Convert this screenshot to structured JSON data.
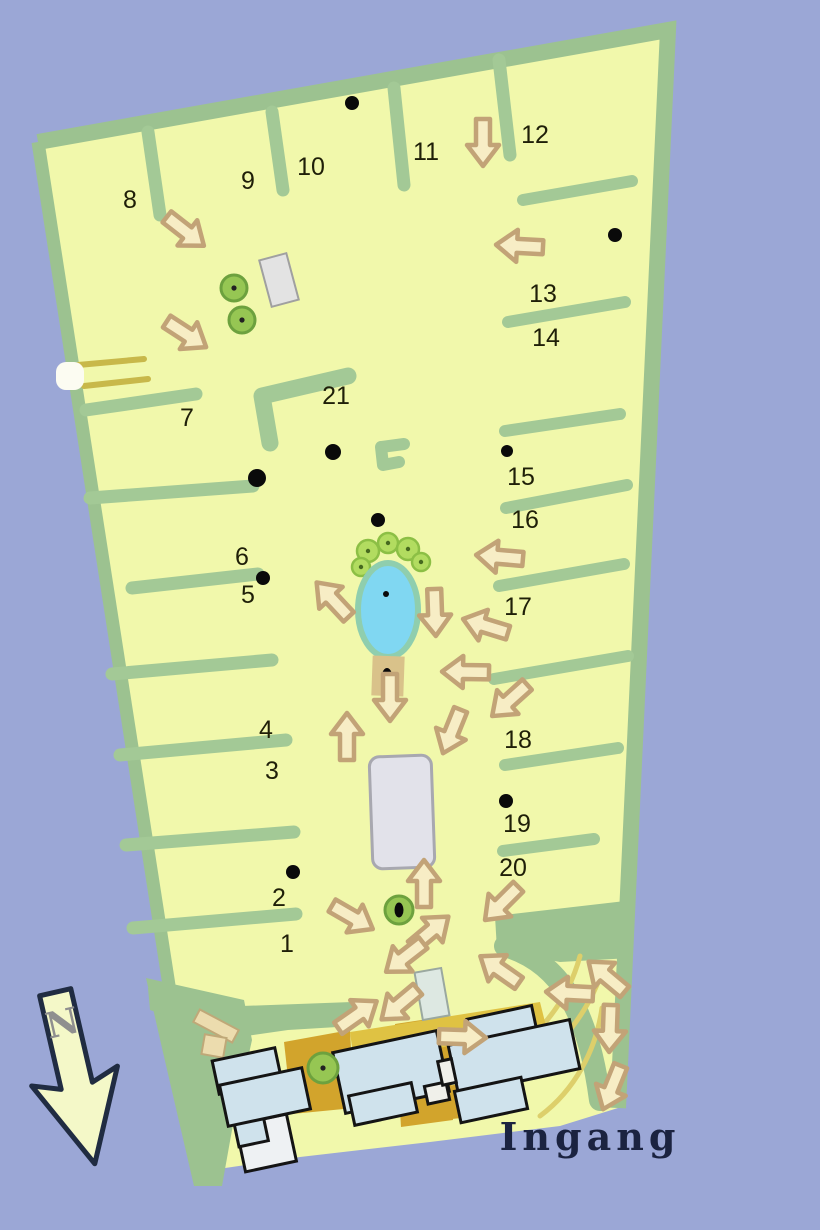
{
  "labels": {
    "entrance": "Ingang",
    "north_letter": "N"
  },
  "colors": {
    "water": "#9ba7d6",
    "field": "#f1f8ab",
    "border": "#9cc290",
    "path": "#a3c996",
    "arrow_fill": "#f7edc5",
    "arrow_stroke": "#c2a377",
    "pond_fill": "#80d7f2",
    "pond_rim": "#8fceae",
    "tree_fill": "#96c653",
    "tree_ring": "#6da13e",
    "tree_dot": "#222222",
    "bush_fill": "#b2dc60",
    "bush_ring": "#8cbf45",
    "bush_dot": "#46691f",
    "building_fill": "#cfe2ec",
    "building_stroke": "#141414",
    "gray_fill": "#e2e2ea",
    "gray_stroke": "#a8a8b0",
    "ochre": "#d2a42c",
    "ochre_light": "#dfc243",
    "stripe": "#c8b84a",
    "curve": "#ddcf6b",
    "text": "#1f1f08",
    "entrance_text": "#1b2340",
    "north_fill": "#f4f8c8",
    "north_stroke": "#202c42",
    "north_letter": "#8f8f8f",
    "tan": "#d9c28a",
    "pale_rect": "#dde8e2",
    "beige": "#ecdcae",
    "beige_stroke": "#bfa878",
    "white_bar": "#fcfcf2",
    "white_bldg": "#eef1f3",
    "notch": "#f0f0ea",
    "dot": "#0a0a0a"
  },
  "map": {
    "field_outline": [
      [
        38,
        142
      ],
      [
        668,
        30
      ],
      [
        618,
        1108
      ],
      [
        560,
        1126
      ],
      [
        430,
        1142
      ],
      [
        300,
        1157
      ],
      [
        198,
        1172
      ]
    ],
    "border_top_right": "M 38 142 L 668 30 L 618 1108",
    "border_left": "M 38 142 L 198 1172",
    "green_patch": [
      [
        146,
        978
      ],
      [
        244,
        1000
      ],
      [
        252,
        1040
      ],
      [
        232,
        1130
      ],
      [
        222,
        1186
      ],
      [
        194,
        1186
      ],
      [
        162,
        1048
      ]
    ],
    "green_band": [
      [
        148,
        988
      ],
      [
        242,
        1006
      ],
      [
        352,
        1002
      ],
      [
        354,
        1026
      ],
      [
        288,
        1030
      ],
      [
        232,
        1038
      ],
      [
        150,
        1010
      ]
    ],
    "green_wedge": [
      [
        495,
        916
      ],
      [
        634,
        900
      ],
      [
        631,
        958
      ],
      [
        560,
        962
      ],
      [
        497,
        950
      ]
    ],
    "crescent": "M 505 946 C 560 962 588 1010 600 1100",
    "yellow_curves": [
      "M 492 1062 C 530 1046 566 1008 580 956",
      "M 500 1082 C 548 1062 586 1022 604 966",
      "M 540 1116 C 575 1090 596 1050 602 1008"
    ],
    "teeth_left": [
      [
        [
          86,
          410
        ],
        [
          196,
          394
        ]
      ],
      [
        [
          90,
          498
        ],
        [
          253,
          486
        ]
      ],
      [
        [
          132,
          588
        ],
        [
          258,
          574
        ]
      ],
      [
        [
          112,
          674
        ],
        [
          272,
          660
        ]
      ],
      [
        [
          120,
          755
        ],
        [
          286,
          740
        ]
      ],
      [
        [
          126,
          845
        ],
        [
          294,
          832
        ]
      ],
      [
        [
          133,
          928
        ],
        [
          296,
          914
        ]
      ]
    ],
    "teeth_top": [
      [
        [
          148,
          132
        ],
        [
          160,
          215
        ]
      ],
      [
        [
          272,
          112
        ],
        [
          283,
          190
        ]
      ],
      [
        [
          394,
          88
        ],
        [
          404,
          185
        ]
      ],
      [
        [
          499,
          60
        ],
        [
          510,
          155
        ]
      ]
    ],
    "teeth_right": [
      [
        [
          523,
          200
        ],
        [
          632,
          181
        ]
      ],
      [
        [
          508,
          322
        ],
        [
          625,
          302
        ]
      ],
      [
        [
          505,
          431
        ],
        [
          620,
          414
        ]
      ],
      [
        [
          506,
          508
        ],
        [
          627,
          485
        ]
      ],
      [
        [
          499,
          586
        ],
        [
          624,
          564
        ]
      ],
      [
        [
          494,
          679
        ],
        [
          628,
          656
        ]
      ],
      [
        [
          505,
          765
        ],
        [
          618,
          748
        ]
      ],
      [
        [
          503,
          851
        ],
        [
          594,
          839
        ]
      ]
    ],
    "l_path": "M 270 443 L 262 396 L 348 376",
    "c_path": "M 404 444 L 381 447 L 383 465 L 399 462",
    "stripes": [
      [
        [
          78,
          365
        ],
        [
          144,
          359
        ]
      ],
      [
        [
          84,
          386
        ],
        [
          148,
          379
        ]
      ]
    ],
    "white_bar": {
      "x": 56,
      "y": 362,
      "w": 28,
      "h": 28
    },
    "ochre_polys": [
      {
        "pts": [
          [
            284,
            1042
          ],
          [
            350,
            1030
          ],
          [
            354,
            1108
          ],
          [
            292,
            1114
          ]
        ],
        "tone": "ochre"
      },
      {
        "pts": [
          [
            395,
            1024
          ],
          [
            448,
            1016
          ],
          [
            453,
            1120
          ],
          [
            401,
            1127
          ]
        ],
        "tone": "ochre"
      },
      {
        "pts": [
          [
            350,
            1032
          ],
          [
            540,
            1002
          ],
          [
            547,
            1030
          ],
          [
            354,
            1062
          ]
        ],
        "tone": "ochre_light"
      },
      {
        "pts": [
          [
            448,
            1086
          ],
          [
            476,
            1081
          ],
          [
            479,
            1116
          ],
          [
            452,
            1119
          ]
        ],
        "tone": "ochre"
      }
    ],
    "pond": {
      "cx": 388,
      "cy": 610,
      "rx": 30,
      "ry": 47,
      "dot_x": 386,
      "dot_y": 594
    },
    "bushes": [
      {
        "x": 368,
        "y": 551,
        "r": 11
      },
      {
        "x": 388,
        "y": 543,
        "r": 10
      },
      {
        "x": 408,
        "y": 549,
        "r": 11
      },
      {
        "x": 421,
        "y": 562,
        "r": 9
      },
      {
        "x": 361,
        "y": 567,
        "r": 9
      }
    ],
    "tan_rect": {
      "cx": 388,
      "cy": 676,
      "w": 32,
      "h": 40,
      "rot": 2
    },
    "trees": [
      {
        "x": 234,
        "y": 288,
        "r": 13
      },
      {
        "x": 242,
        "y": 320,
        "r": 13
      },
      {
        "x": 323,
        "y": 1068,
        "r": 15
      },
      {
        "x": 399,
        "y": 910,
        "r": 14
      }
    ],
    "structures": {
      "gray_top": {
        "cx": 279,
        "cy": 280,
        "w": 28,
        "h": 48,
        "rot": -15
      },
      "gray_center": {
        "cx": 402,
        "cy": 812,
        "w": 62,
        "h": 112,
        "rot": -2,
        "rx": 10
      },
      "small_pale": {
        "cx": 432,
        "cy": 994,
        "w": 27,
        "h": 48,
        "rot": -10
      },
      "beige_bar": {
        "cx": 216,
        "cy": 1026,
        "w": 44,
        "h": 14,
        "rot": 28
      },
      "beige_sq": {
        "cx": 214,
        "cy": 1046,
        "w": 22,
        "h": 20,
        "rot": 10
      }
    },
    "buildings": [
      {
        "cx": 266,
        "cy": 1143,
        "w": 52,
        "h": 48,
        "rot": -12,
        "fill": "white_bldg"
      },
      {
        "cx": 247,
        "cy": 1071,
        "w": 64,
        "h": 34,
        "rot": -12,
        "fill": "building_fill"
      },
      {
        "cx": 251,
        "cy": 1131,
        "w": 30,
        "h": 26,
        "rot": -12,
        "fill": "building_fill"
      },
      {
        "cx": 265,
        "cy": 1097,
        "w": 84,
        "h": 42,
        "rot": -12,
        "fill": "building_fill"
      },
      {
        "cx": 391,
        "cy": 1072,
        "w": 106,
        "h": 62,
        "rot": -12,
        "fill": "building_fill"
      },
      {
        "cx": 383,
        "cy": 1104,
        "w": 64,
        "h": 30,
        "rot": -12,
        "fill": "building_fill"
      },
      {
        "cx": 437,
        "cy": 1093,
        "w": 22,
        "h": 18,
        "rot": -12,
        "fill": "notch"
      },
      {
        "cx": 503,
        "cy": 1030,
        "w": 66,
        "h": 36,
        "rot": -12,
        "fill": "building_fill"
      },
      {
        "cx": 514,
        "cy": 1057,
        "w": 124,
        "h": 50,
        "rot": -12,
        "fill": "building_fill"
      },
      {
        "cx": 491,
        "cy": 1100,
        "w": 68,
        "h": 32,
        "rot": -12,
        "fill": "building_fill"
      },
      {
        "cx": 447,
        "cy": 1072,
        "w": 14,
        "h": 24,
        "rot": -12,
        "fill": "notch"
      }
    ],
    "sections": [
      {
        "label": "1",
        "x": 287,
        "y": 944
      },
      {
        "label": "2",
        "x": 279,
        "y": 898
      },
      {
        "label": "3",
        "x": 272,
        "y": 771
      },
      {
        "label": "4",
        "x": 266,
        "y": 730
      },
      {
        "label": "5",
        "x": 248,
        "y": 595
      },
      {
        "label": "6",
        "x": 242,
        "y": 557
      },
      {
        "label": "7",
        "x": 187,
        "y": 418
      },
      {
        "label": "8",
        "x": 130,
        "y": 200
      },
      {
        "label": "9",
        "x": 248,
        "y": 181
      },
      {
        "label": "10",
        "x": 311,
        "y": 167
      },
      {
        "label": "11",
        "x": 426,
        "y": 152
      },
      {
        "label": "12",
        "x": 535,
        "y": 135
      },
      {
        "label": "13",
        "x": 543,
        "y": 294
      },
      {
        "label": "14",
        "x": 546,
        "y": 338
      },
      {
        "label": "15",
        "x": 521,
        "y": 477
      },
      {
        "label": "16",
        "x": 525,
        "y": 520
      },
      {
        "label": "17",
        "x": 518,
        "y": 607
      },
      {
        "label": "18",
        "x": 518,
        "y": 740
      },
      {
        "label": "19",
        "x": 517,
        "y": 824
      },
      {
        "label": "20",
        "x": 513,
        "y": 868
      },
      {
        "label": "21",
        "x": 336,
        "y": 396
      }
    ],
    "arrows": [
      {
        "x": 185,
        "y": 231,
        "rot": 38
      },
      {
        "x": 186,
        "y": 334,
        "rot": 33
      },
      {
        "x": 483,
        "y": 142,
        "rot": 90
      },
      {
        "x": 520,
        "y": 246,
        "rot": 183
      },
      {
        "x": 500,
        "y": 557,
        "rot": 185
      },
      {
        "x": 333,
        "y": 600,
        "rot": -133
      },
      {
        "x": 435,
        "y": 612,
        "rot": 88
      },
      {
        "x": 486,
        "y": 626,
        "rot": 197
      },
      {
        "x": 466,
        "y": 672,
        "rot": 181
      },
      {
        "x": 510,
        "y": 700,
        "rot": 138
      },
      {
        "x": 452,
        "y": 731,
        "rot": 112
      },
      {
        "x": 390,
        "y": 697,
        "rot": 90
      },
      {
        "x": 347,
        "y": 737,
        "rot": -90
      },
      {
        "x": 502,
        "y": 903,
        "rot": 135
      },
      {
        "x": 352,
        "y": 917,
        "rot": 30
      },
      {
        "x": 424,
        "y": 884,
        "rot": -90
      },
      {
        "x": 430,
        "y": 932,
        "rot": -40
      },
      {
        "x": 405,
        "y": 957,
        "rot": 142
      },
      {
        "x": 400,
        "y": 1004,
        "rot": 140
      },
      {
        "x": 357,
        "y": 1015,
        "rot": -35
      },
      {
        "x": 462,
        "y": 1037,
        "rot": 2
      },
      {
        "x": 500,
        "y": 970,
        "rot": -145
      },
      {
        "x": 607,
        "y": 977,
        "rot": -140
      },
      {
        "x": 570,
        "y": 993,
        "rot": 183
      },
      {
        "x": 610,
        "y": 1028,
        "rot": 92
      },
      {
        "x": 612,
        "y": 1087,
        "rot": 112
      }
    ],
    "dots": [
      {
        "x": 352,
        "y": 103,
        "r": 7
      },
      {
        "x": 615,
        "y": 235,
        "r": 7
      },
      {
        "x": 333,
        "y": 452,
        "r": 8
      },
      {
        "x": 257,
        "y": 478,
        "r": 9
      },
      {
        "x": 378,
        "y": 520,
        "r": 7
      },
      {
        "x": 263,
        "y": 578,
        "r": 7
      },
      {
        "x": 507,
        "y": 451,
        "r": 6
      },
      {
        "x": 506,
        "y": 801,
        "r": 7
      },
      {
        "x": 293,
        "y": 872,
        "r": 7
      },
      {
        "x": 386,
        "y": 594,
        "r": 3
      },
      {
        "x": 387,
        "y": 676,
        "rx": 5,
        "ry": 8
      },
      {
        "x": 399,
        "y": 910,
        "rx": 4.5,
        "ry": 7.5
      }
    ]
  }
}
